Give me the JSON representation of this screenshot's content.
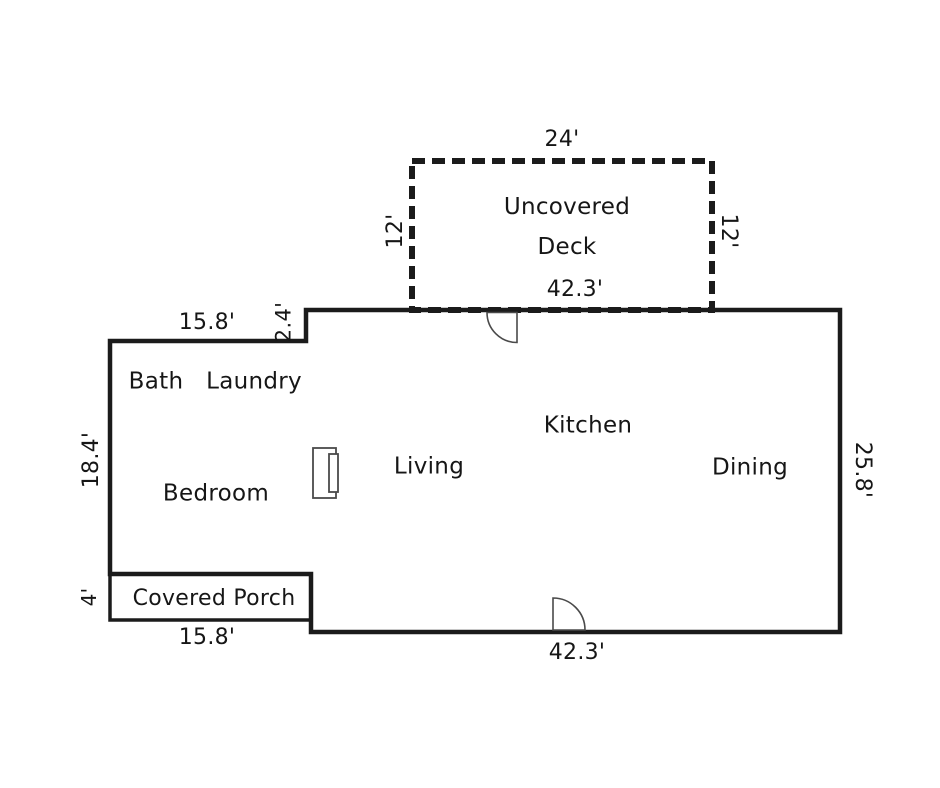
{
  "floor_plan": {
    "deck": {
      "name": "Uncovered Deck",
      "dim_top": "24'",
      "dim_left": "12'",
      "dim_right": "12'",
      "dim_bottom": "42.3'"
    },
    "rooms": {
      "bath": "Bath",
      "laundry": "Laundry",
      "bedroom": "Bedroom",
      "living": "Living",
      "kitchen": "Kitchen",
      "dining": "Dining",
      "covered_porch": "Covered Porch"
    },
    "dims": {
      "upper_left_width": "15.8'",
      "step_height": "2.4'",
      "left_height": "18.4'",
      "porch_height": "4'",
      "porch_width": "15.8'",
      "bottom_width": "42.3'",
      "right_height": "25.8'"
    },
    "colors": {
      "line": "#1b1b1b",
      "door_line": "#4a4a4a",
      "background": "#ffffff"
    }
  }
}
